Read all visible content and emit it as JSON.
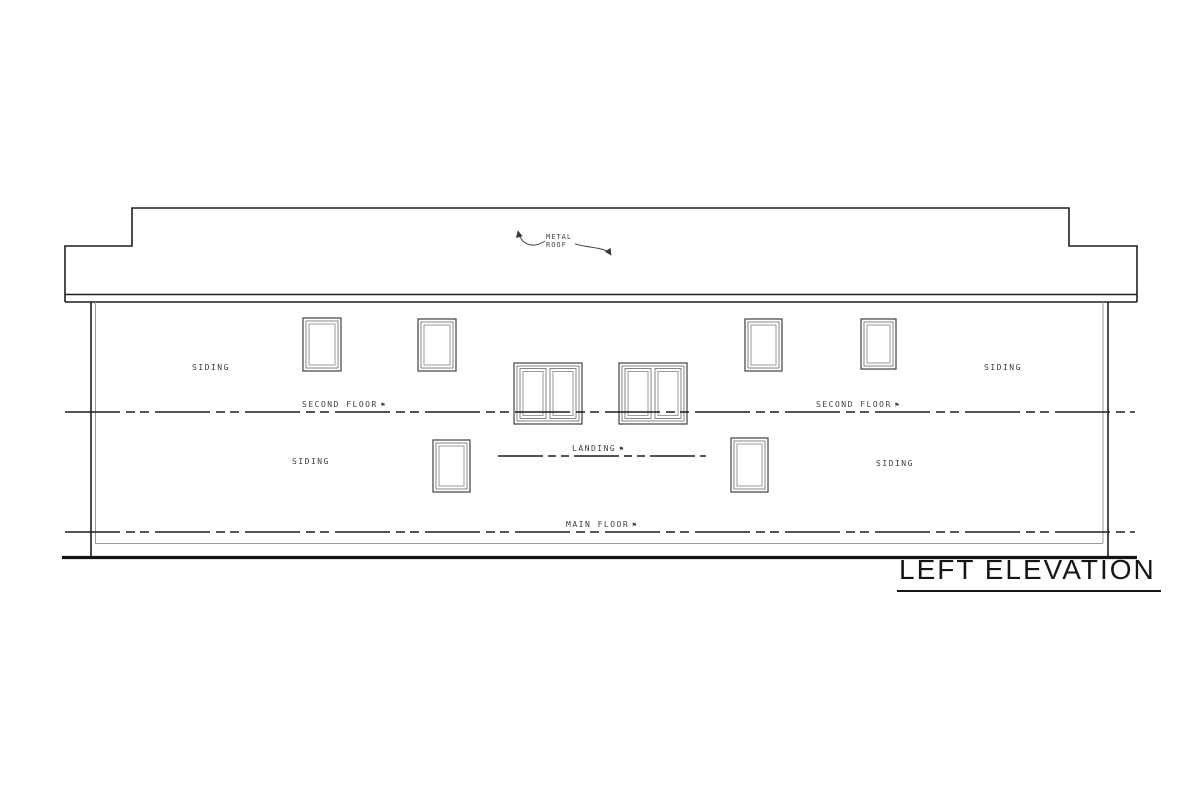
{
  "sheet": {
    "title": {
      "text": "LEFT ELEVATION"
    },
    "roof_note": {
      "line1": "METAL",
      "line2": "ROOF"
    },
    "floor_lines": {
      "second_floor_left": "SECOND FLOOR",
      "second_floor_right": "SECOND FLOOR",
      "landing": "LANDING",
      "main_floor": "MAIN FLOOR"
    },
    "siding_notes": {
      "upper_left": "SIDING",
      "upper_right": "SIDING",
      "lower_left": "SIDING",
      "lower_right": "SIDING"
    },
    "icons": {
      "datum_flag": "⚑"
    },
    "colors": {
      "line_dark": "#1f1f1f",
      "line_medium": "#4a4a4a",
      "line_light": "#9a9a9a",
      "ground": "#141414",
      "text": "#3d3d3d",
      "background": "#ffffff"
    }
  }
}
